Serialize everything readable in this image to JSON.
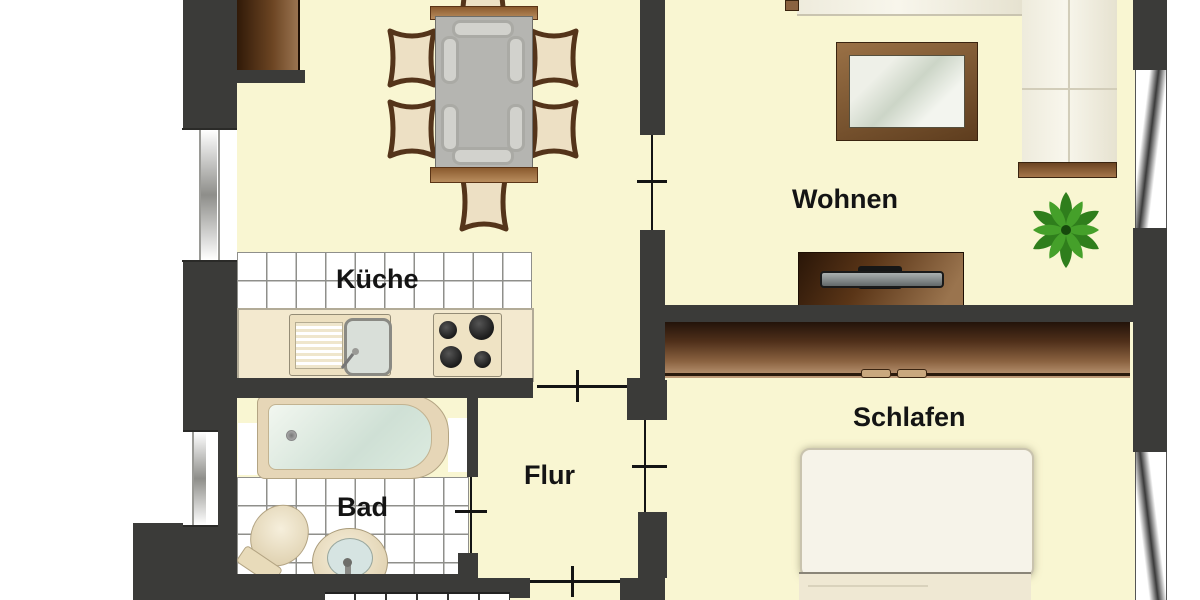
{
  "plan_title": "Apartment floor plan",
  "rooms": {
    "wohnen": {
      "label": "Wohnen"
    },
    "kueche": {
      "label": "Küche"
    },
    "schlafen": {
      "label": "Schlafen"
    },
    "flur": {
      "label": "Flur"
    },
    "bad": {
      "label": "Bad"
    }
  },
  "palette": {
    "floor": "#F9F6D2",
    "wall": "#3B3B39",
    "outside": "#FFFFFF",
    "wood_dark": "#4A2B12",
    "wood_light": "#B98D5E",
    "tile_line": "#8F8F8B",
    "tub_water": "#CFE0D5",
    "sofa_cream": "#F2EFE2",
    "plant_green": "#2F7E1C",
    "label_text": "#141414"
  }
}
